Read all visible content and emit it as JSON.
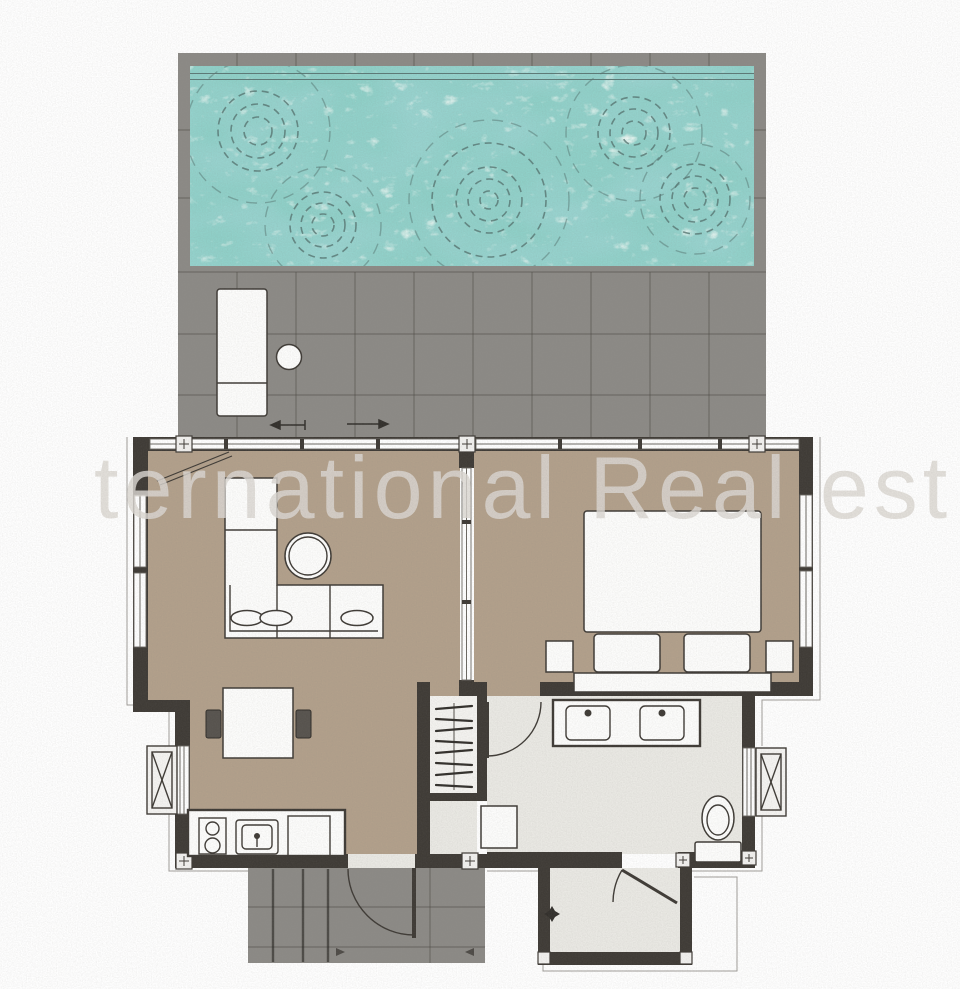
{
  "watermark": {
    "text": "ternational Real est"
  },
  "colors": {
    "page_bg": "#ffffff",
    "water": "#8fd0c8",
    "deck": "#8c8a86",
    "grout": "#464441",
    "wall": "#3f3b36",
    "wood": "#b2a08b",
    "bath": "#eae9e4",
    "furn": "#fdfdfc",
    "line": "#3f3b36",
    "ripple": "#567572",
    "chair": "#57534e",
    "outline": "#a09d99",
    "watermark": "#dcd8d3"
  }
}
